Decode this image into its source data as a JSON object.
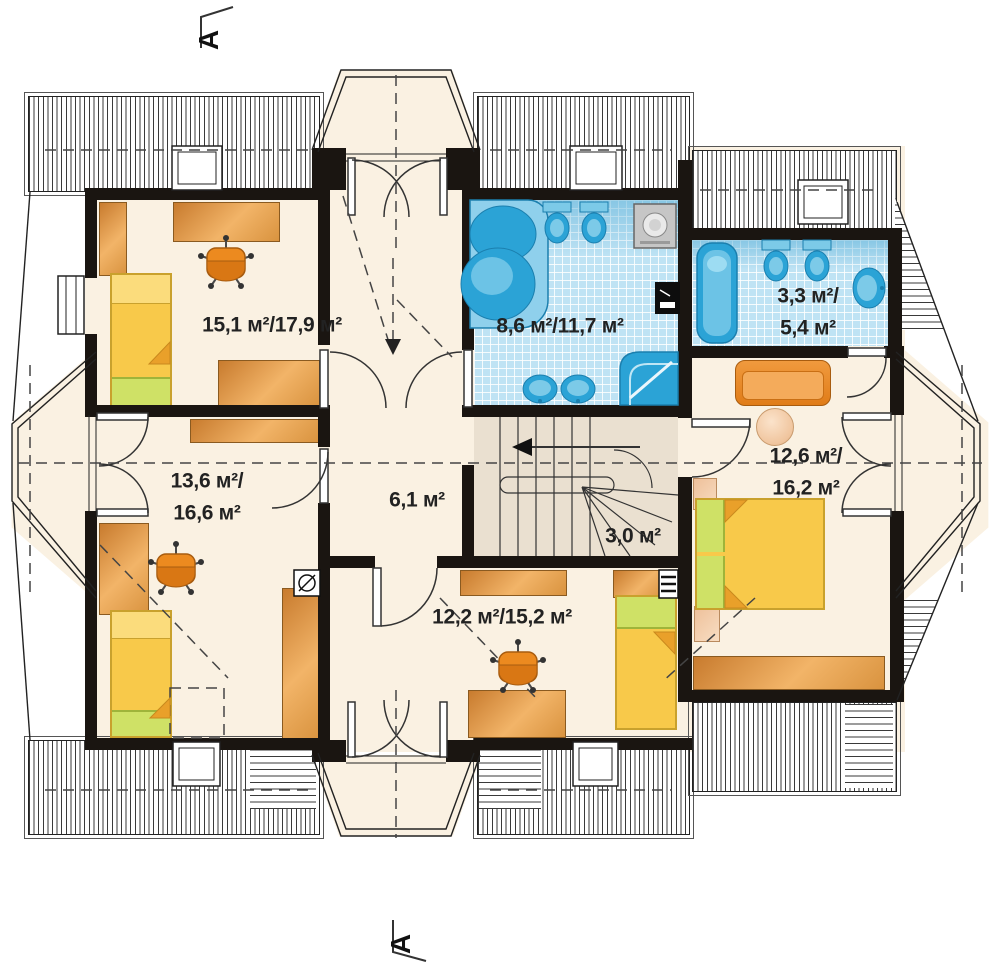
{
  "section_markers": {
    "top_label": "A",
    "bottom_label": "A"
  },
  "rooms": [
    {
      "name": "room-top-left",
      "label": "15,1 м²/17,9 м²"
    },
    {
      "name": "bathroom-main",
      "label": "8,6 м²/11,7 м²"
    },
    {
      "name": "bathroom-small",
      "label": "3,3 м²/\n5,4 м²"
    },
    {
      "name": "room-left",
      "label": "13,6 м²/\n16,6 м²"
    },
    {
      "name": "hallway",
      "label": "6,1 м²"
    },
    {
      "name": "staircase",
      "label": "3,0 м²"
    },
    {
      "name": "room-right",
      "label": "12,6 м²/\n16,2 м²"
    },
    {
      "name": "room-bottom",
      "label": "12,2 м²/15,2 м²"
    }
  ],
  "colors": {
    "wall": "#1a1511",
    "floor": "#faf1e2",
    "bathroom_tile": "#bfe3f4",
    "fixture_blue": "#2ba3d6",
    "furniture_orange": "#e09339",
    "bed_yellow": "#f8c94a",
    "bed_green": "#cfe166",
    "stair_floor": "#eae0d0"
  }
}
